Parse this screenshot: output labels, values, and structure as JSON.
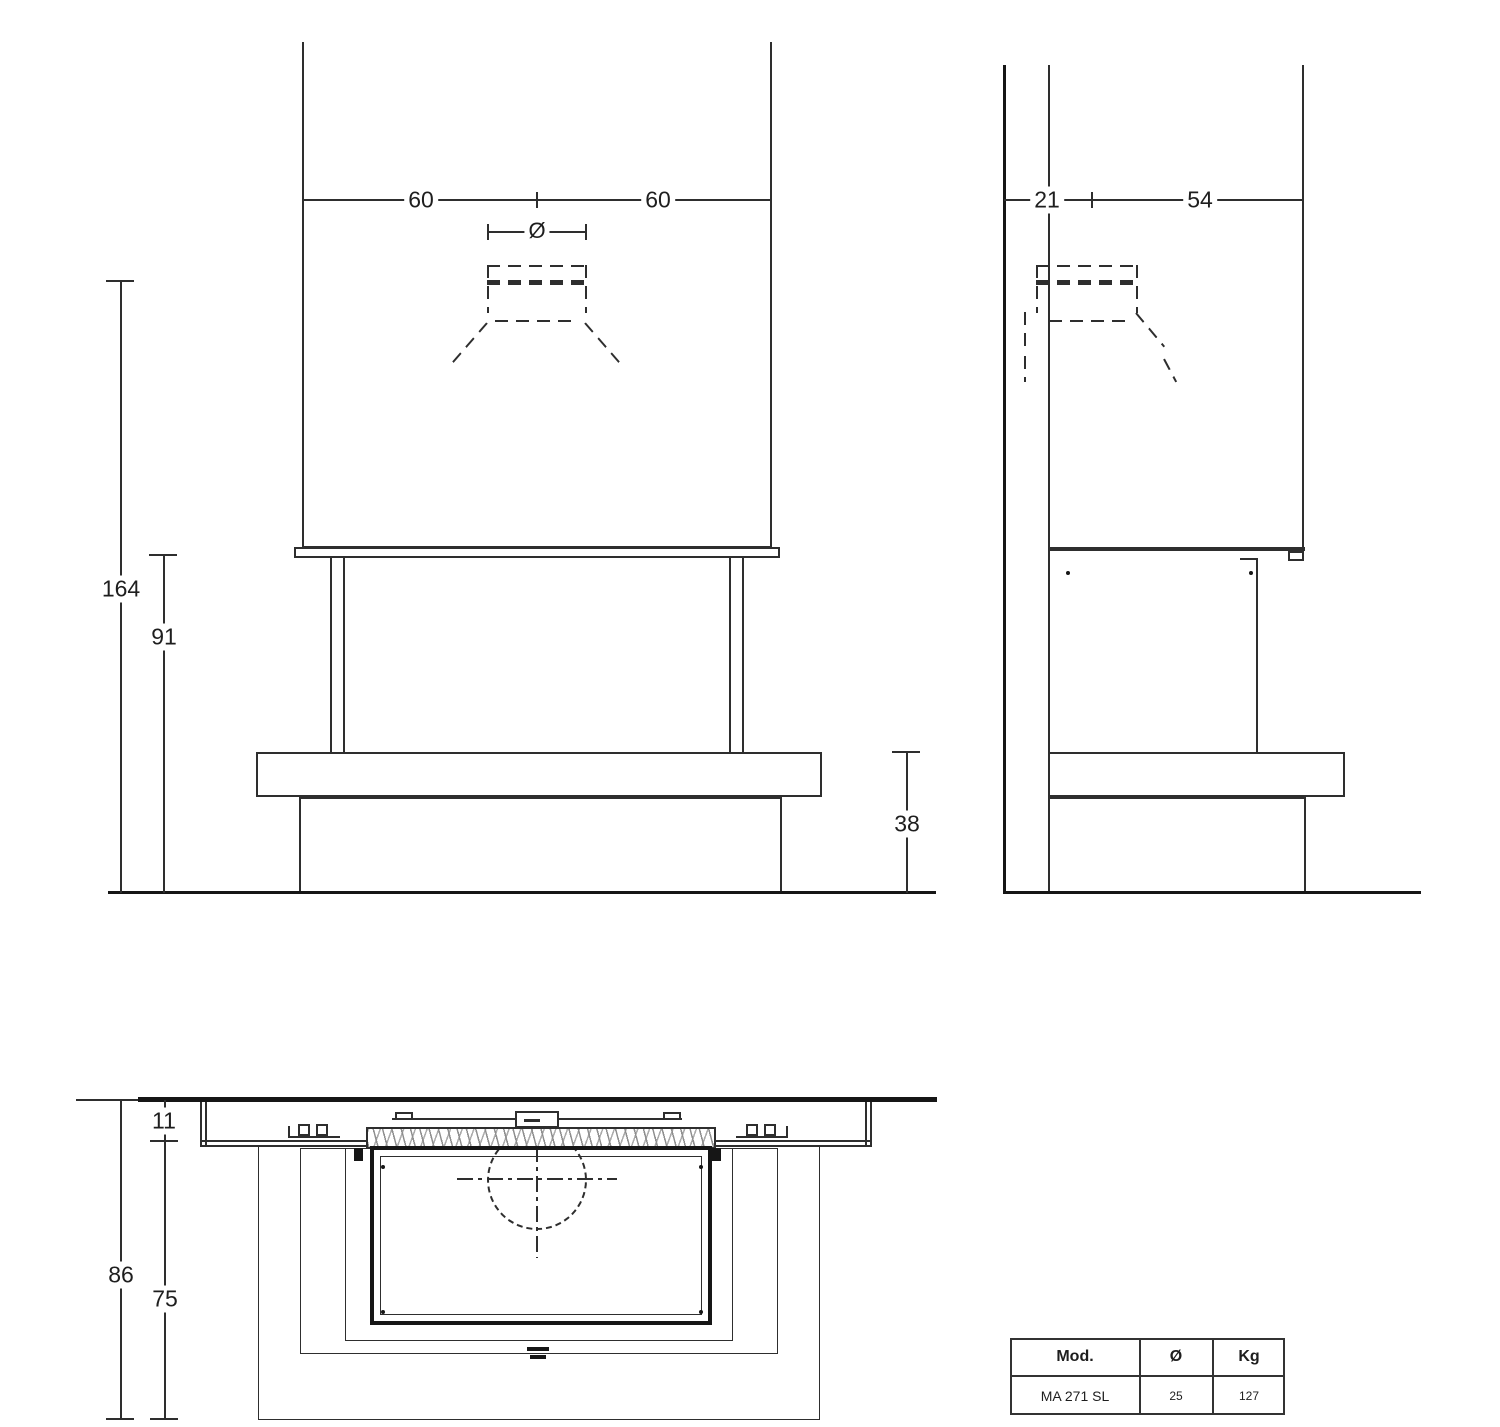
{
  "colors": {
    "line": "#2e2e2e",
    "background": "#ffffff"
  },
  "front_view": {
    "dim_width_left": "60",
    "dim_width_right": "60",
    "flue_diameter_symbol": "Ø",
    "dim_height_flue_center": "164",
    "dim_height_opening": "91",
    "dim_height_bench": "38"
  },
  "side_view": {
    "dim_wall_to_flue": "21",
    "dim_flue_to_front": "54"
  },
  "plan_view": {
    "dim_mantel_depth": "11",
    "dim_total_depth": "86",
    "dim_hearth_depth": "75"
  },
  "spec_table": {
    "headers": {
      "model": "Mod.",
      "diameter": "Ø",
      "weight": "Kg"
    },
    "row": {
      "model": "MA 271 SL",
      "diameter": "25",
      "weight": "127"
    }
  }
}
